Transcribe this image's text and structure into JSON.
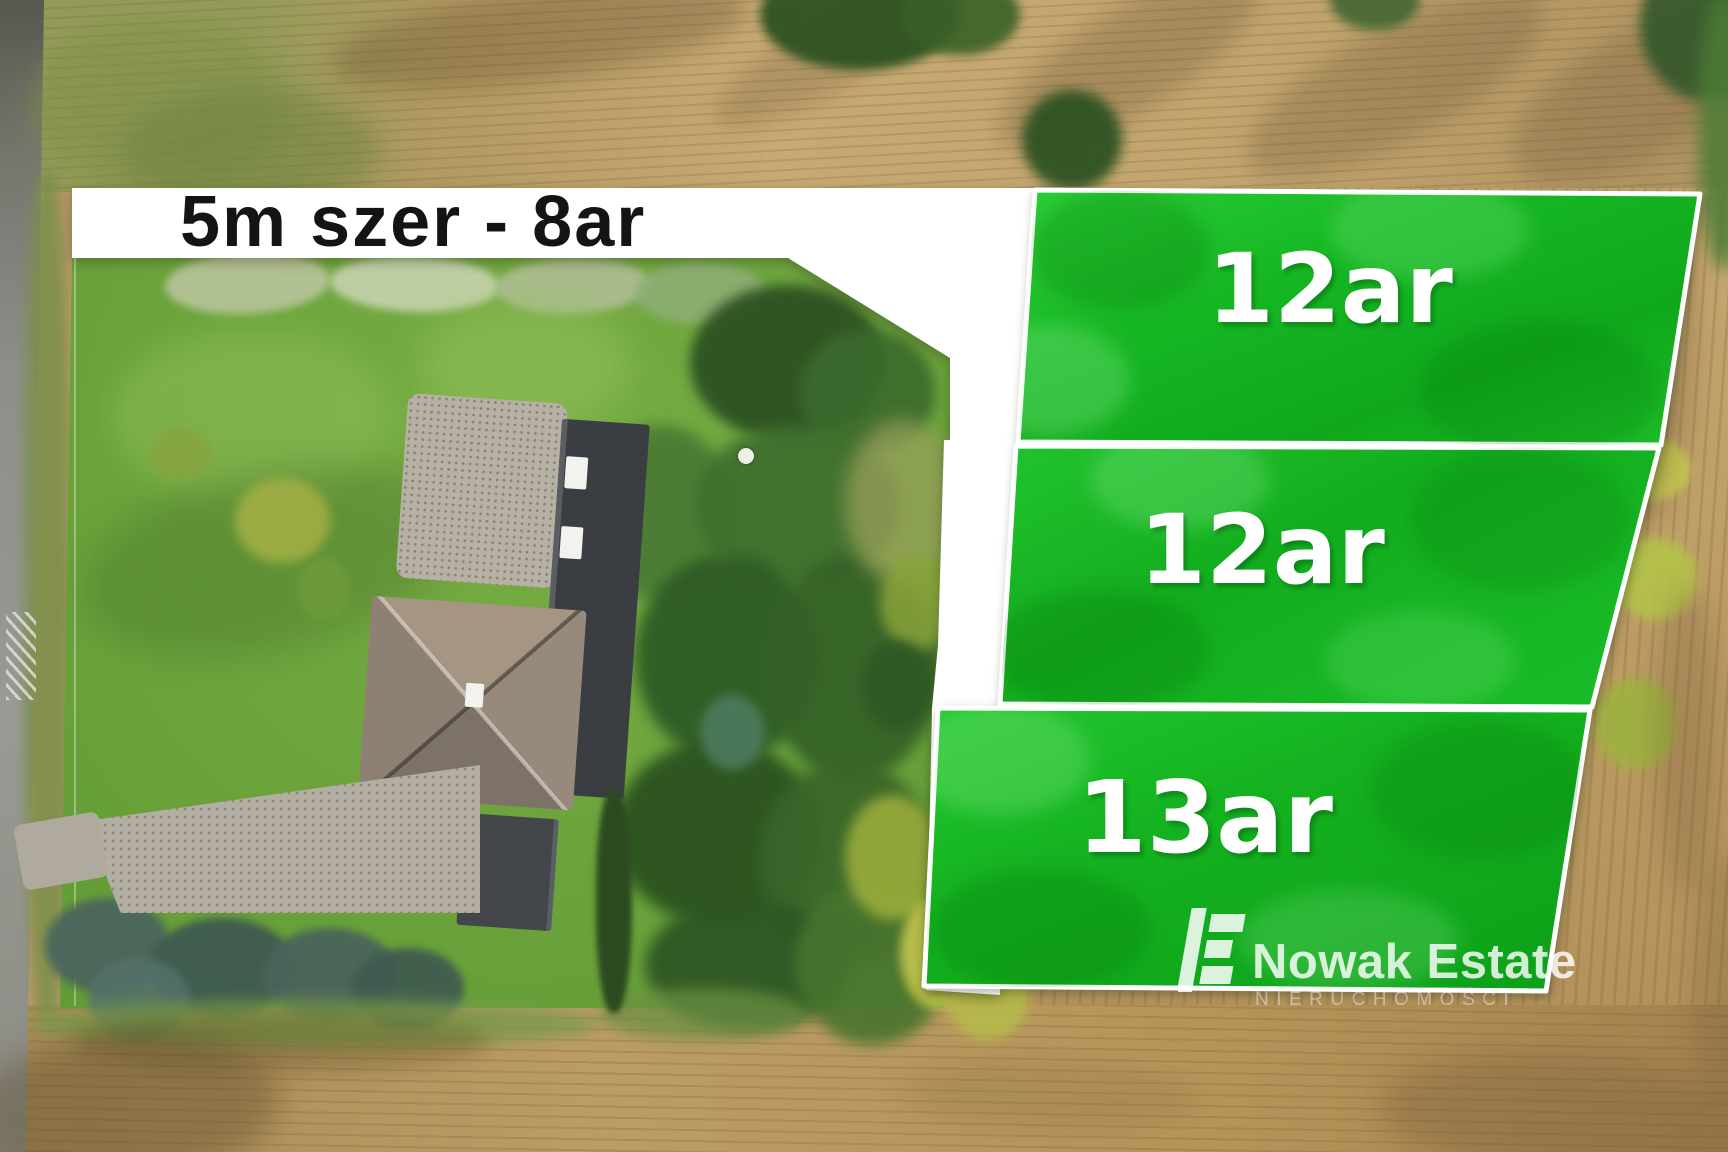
{
  "banner": {
    "text": "5m szer - 8ar"
  },
  "parcels": [
    {
      "label": "12ar"
    },
    {
      "label": "12ar"
    },
    {
      "label": "13ar"
    }
  ],
  "logo": {
    "name": "Nowak Estate",
    "subtitle": "NIERUCHOMOŚCI"
  },
  "colors": {
    "parcel_green": "#14b220",
    "parcel_green_light": "#2bcf38",
    "parcel_border": "#ffffff",
    "banner_bg": "#ffffff",
    "banner_text": "#141414",
    "label_text": "#ffffff"
  }
}
